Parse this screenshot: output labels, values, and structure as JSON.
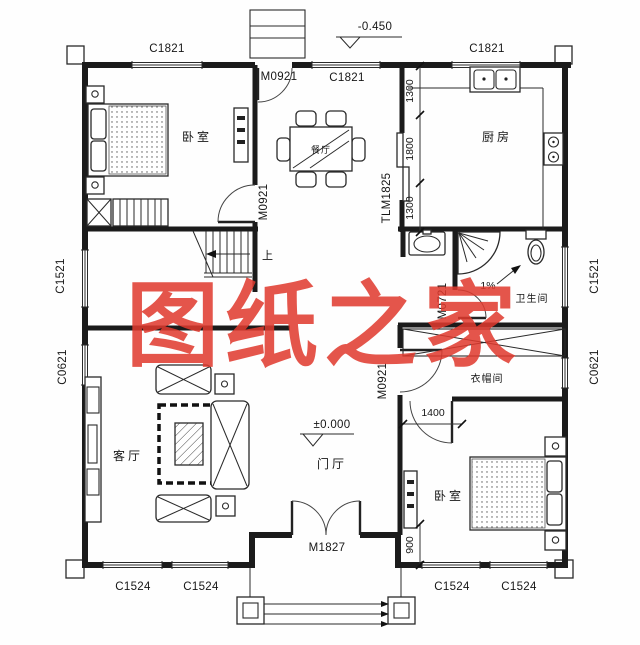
{
  "watermark": "图纸之家",
  "rooms": {
    "bedroom_top": "卧室",
    "dining": "餐厅",
    "kitchen": "厨房",
    "bathroom": "卫生间",
    "cloakroom": "衣帽间",
    "living": "客厅",
    "foyer": "门厅",
    "bedroom_bottom": "卧室"
  },
  "doors": {
    "rear_door": "M0921",
    "bedroom_top_door": "M0921",
    "kitchen_slide_door": "TLM1825",
    "bathroom_door": "M0721",
    "cloakroom_door": "M0921",
    "entry_door": "M1827"
  },
  "windows": {
    "top_left": "C1821",
    "top_middle": "C1821",
    "top_right": "C1821",
    "left_upper": "C1521",
    "left_lower": "C0621",
    "right_upper": "C1521",
    "right_lower": "C0621",
    "bottom_living_1": "C1524",
    "bottom_living_2": "C1524",
    "bottom_bedroom_1": "C1524",
    "bottom_bedroom_2": "C1524"
  },
  "dimensions": {
    "kitchen_1": "1300",
    "kitchen_2": "1800",
    "kitchen_3": "1300",
    "bedroom_width": "1400",
    "bedroom_side": "900"
  },
  "elevations": {
    "rear": "-0.450",
    "entry": "±0.000"
  },
  "annotations": {
    "stairs_up": "上",
    "slope": "1%"
  }
}
